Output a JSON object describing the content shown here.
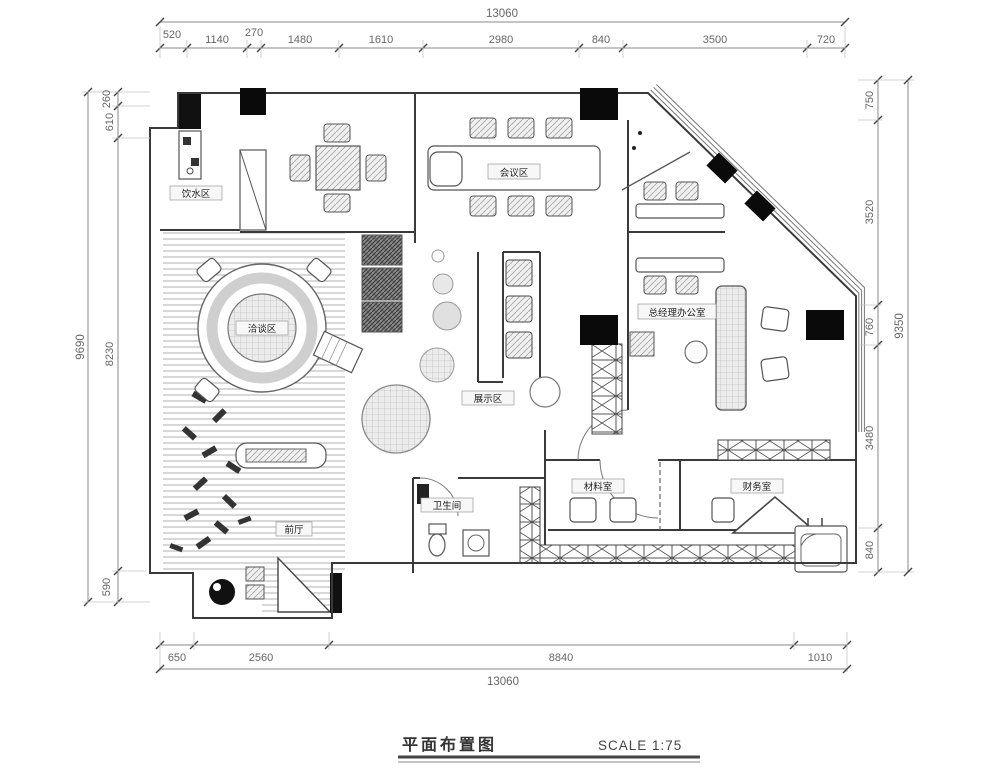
{
  "title_block": {
    "name": "平面布置图",
    "scale": "SCALE 1:75"
  },
  "dims": {
    "top": {
      "total": "13060",
      "segments": [
        "520",
        "1140",
        "270",
        "1480",
        "1610",
        "2980",
        "840",
        "3500",
        "720"
      ]
    },
    "bottom": {
      "total": "13060",
      "segments": [
        "650",
        "2560",
        "8840",
        "1010"
      ]
    },
    "left": {
      "total": "9690",
      "segments": [
        "260",
        "610",
        "8230",
        "590"
      ]
    },
    "right": {
      "total": "9350",
      "segments": [
        "750",
        "3520",
        "760",
        "3480",
        "840"
      ]
    }
  },
  "rooms": [
    {
      "label": "饮水区"
    },
    {
      "label": "会议区"
    },
    {
      "label": "洽谈区"
    },
    {
      "label": "展示区"
    },
    {
      "label": "总经理办公室"
    },
    {
      "label": "材料室"
    },
    {
      "label": "财务室"
    },
    {
      "label": "卫生间"
    },
    {
      "label": "前厅"
    }
  ]
}
